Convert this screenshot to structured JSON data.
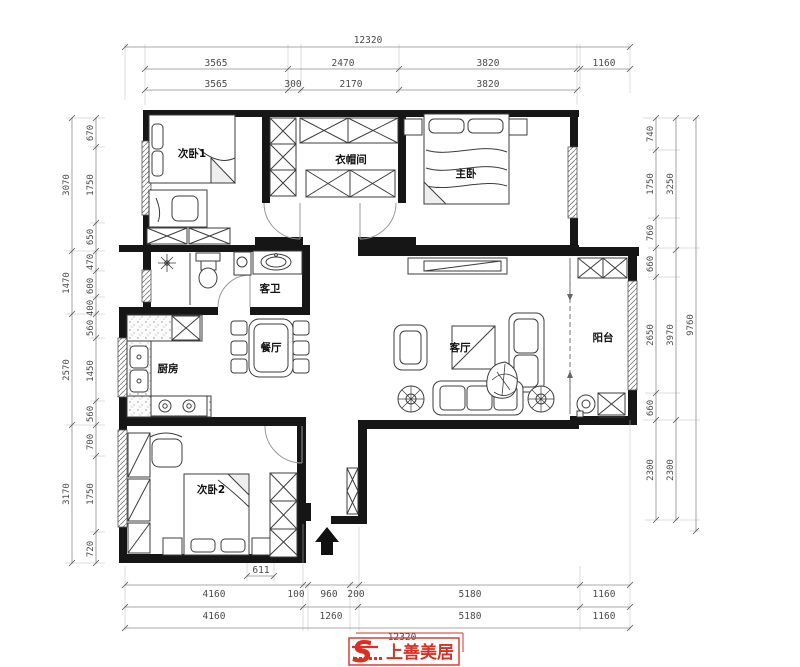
{
  "rooms": {
    "bedroom1": {
      "label": "次卧1"
    },
    "cloakroom": {
      "label": "衣帽间"
    },
    "master_bedroom": {
      "label": "主卧"
    },
    "guest_bathroom": {
      "label": "客卫"
    },
    "kitchen": {
      "label": "厨房"
    },
    "dining_room": {
      "label": "餐厅"
    },
    "living_room": {
      "label": "客厅"
    },
    "balcony": {
      "label": "阳台"
    },
    "bedroom2": {
      "label": "次卧2"
    }
  },
  "dimensions": {
    "top": {
      "overall": "12320",
      "row2": [
        "3565",
        "2470",
        "3820",
        "1160"
      ],
      "row3": [
        "3565",
        "300",
        "2170",
        "3820"
      ]
    },
    "bottom": {
      "row1": [
        "4160",
        "100",
        "960",
        "200",
        "5180",
        "1160"
      ],
      "row2": [
        "4160",
        "1260",
        "5180",
        "1160"
      ],
      "overall": "12320",
      "detail": "611"
    },
    "left": {
      "outer": [
        "3070",
        "1470",
        "2570",
        "3170"
      ],
      "inner": [
        "670",
        "1750",
        "650",
        "470",
        "600",
        "400",
        "560",
        "1450",
        "560",
        "700",
        "1750",
        "720"
      ]
    },
    "right": {
      "inner": [
        "740",
        "1750",
        "760",
        "660",
        "2650",
        "660",
        "2300"
      ],
      "mid": [
        "3250",
        "3970",
        "2300"
      ],
      "overall": "9760"
    }
  },
  "logo": {
    "mark": "S",
    "brand": "上善美居"
  },
  "colors": {
    "wall": "#161616",
    "furniture": "#3c3c3c",
    "dimension_line": "#8c8c8c",
    "dimension_text": "#4a4a4a",
    "logo_red": "#d93025"
  }
}
